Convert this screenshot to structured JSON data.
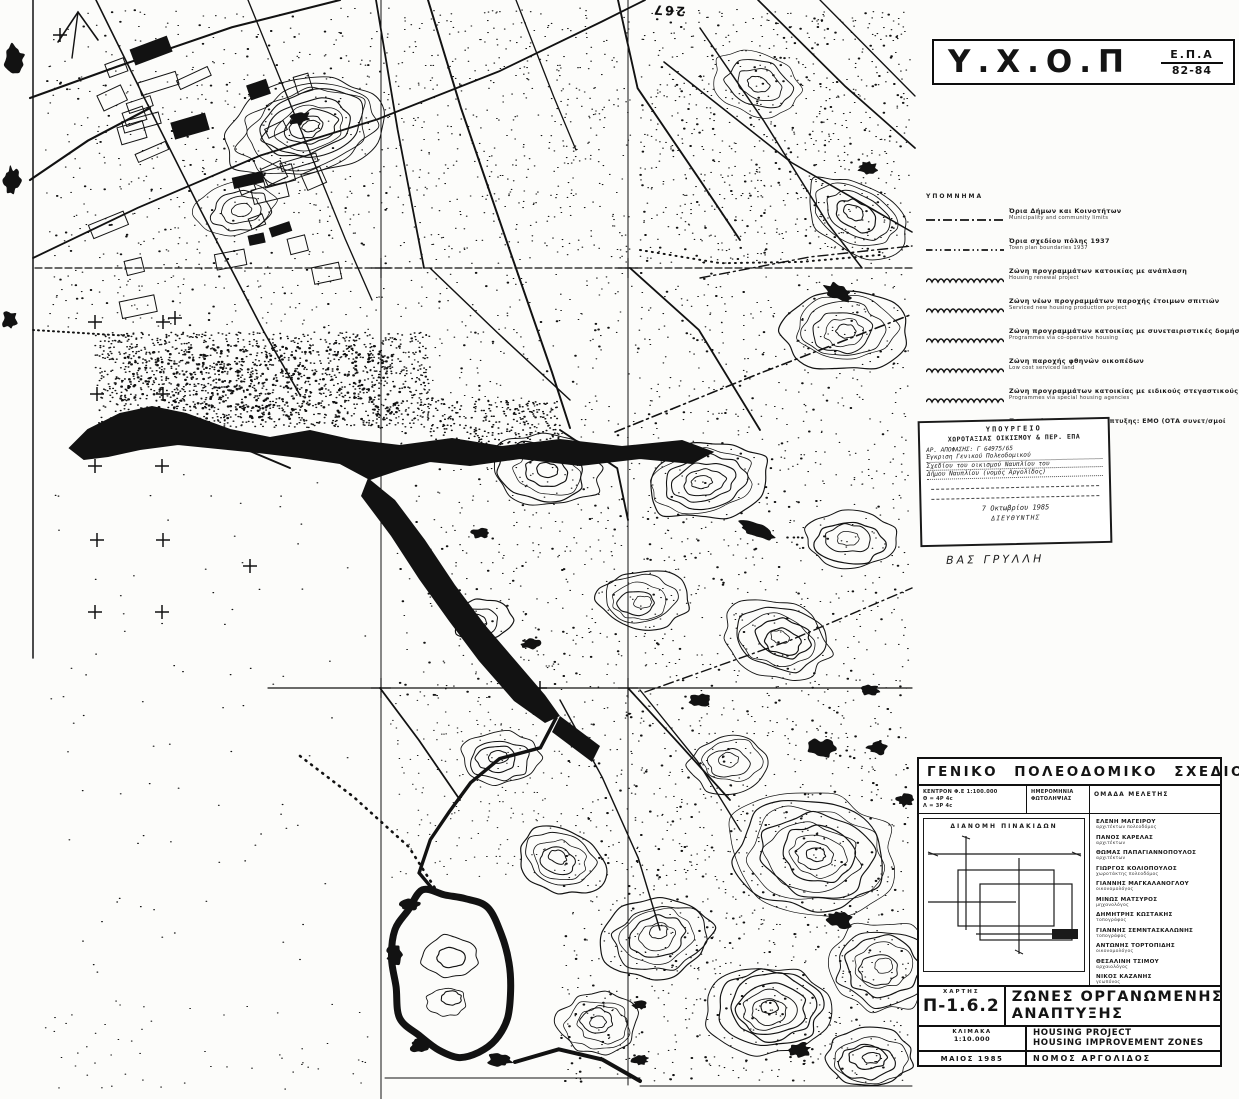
{
  "colors": {
    "ink": "#141414",
    "paper": "#fcfcfa"
  },
  "map": {
    "spot_elevation": "267"
  },
  "title_block": {
    "agency": "Υ.Χ.Ο.Π",
    "program": "Ε.Π.Α",
    "years": "82-84"
  },
  "legend": {
    "heading": "ΥΠΟΜΝΗΜΑ",
    "items": [
      {
        "marker": "dash-dot",
        "label": "Όρια Δήμων και Κοινοτήτων",
        "sublabel": "Municipality and community limits"
      },
      {
        "marker": "dash-dot-dot",
        "label": "Όρια σχεδίου πόλης 1937",
        "sublabel": "Town plan boundaries 1937"
      },
      {
        "marker": "wavy",
        "label": "Ζώνη προγραμμάτων κατοικίας με ανάπλαση",
        "sublabel": "Housing renewal project"
      },
      {
        "marker": "wavy",
        "label": "Ζώνη νέων προγραμμάτων παροχής έτοιμων σπιτιών",
        "sublabel": "Serviced new housing production project"
      },
      {
        "marker": "wavy",
        "label": "Ζώνη προγραμμάτων κατοικίας με συνεταιριστικές δομήσεις",
        "sublabel": "Programmes via co-operative housing"
      },
      {
        "marker": "wavy",
        "label": "Ζώνη παροχής φθηνών οικοπέδων",
        "sublabel": "Low cost serviced land"
      },
      {
        "marker": "wavy",
        "label": "Ζώνη προγραμμάτων κατοικίας με ειδικούς στεγαστικούς φορείς",
        "sublabel": "Programmes via special housing agencies"
      }
    ],
    "note": "Προτεινόμενοι φορείς ανάπτυξης: ΕΜΟ (ΟΤΑ συνετ/σμοί ΟΕΚ)"
  },
  "approval_stamp": {
    "ministry_line1": "ΥΠΟΥΡΓΕΙΟ",
    "ministry_line2": "ΧΩΡΟΤΑΞΙΑΣ ΟΙΚΙΣΜΟΥ & ΠΕΡ. ΕΠΑ",
    "ref_line": "ΑΡ. ΑΠΟΦΑΣΗΣ: Γ 64975/65",
    "body_lines": [
      "Έγκριση Γενικού Πολεοδομικού",
      "Σχεδίου του οικισμού Ναυπλίου του",
      "Δήμου Ναυπλίου (νομός Αργολίδος)"
    ],
    "date": "7 Οκτωβρίου 1985",
    "role": "ΔΙΕΥΘΥΝΤΗΣ",
    "signed_name": "ΒΑΣ ΓΡΥΛΛΗ"
  },
  "info_panel": {
    "title": "ΓΕΝΙΚΟ ΠΟΛΕΟΔΟΜΙΚΟ ΣΧΕΔΙΟ",
    "photo_center_line1": "ΚΕΝΤΡΟΝ Φ.Ε 1:100.000",
    "photo_center_line2": "Θ = 4Ρ 4c",
    "photo_center_line3": "Λ = 3Ρ 4c",
    "photo_date_line1": "ΗΜΕΡΟΜΗΝΙΑ",
    "photo_date_line2": "ΦΩΤΟΛΗΨΙΑΣ",
    "team_label": "ΟΜΑΔΑ ΜΕΛΕΤΗΣ",
    "sheet_index_label": "ΔΙΑΝΟΜΗ ΠΙΝΑΚΙΔΩΝ",
    "team": [
      {
        "name": "ΕΛΕΝΗ ΜΑΓΕΙΡΟΥ",
        "role": "αρχιτέκτων πολεοδόμος"
      },
      {
        "name": "ΠΑΝΟΣ ΚΑΡΕΛΑΣ",
        "role": "αρχιτέκτων"
      },
      {
        "name": "ΘΩΜΑΣ ΠΑΠΑΓΙΑΝΝΟΠΟΥΛΟΣ",
        "role": "αρχιτέκτων"
      },
      {
        "name": "ΓΙΩΡΓΟΣ ΚΟΛΙΟΠΟΥΛΟΣ",
        "role": "χωροτάκτης πολεοδόμος"
      },
      {
        "name": "ΓΙΑΝΝΗΣ ΜΑΓΚΑΛΑΝΟΓΛΟΥ",
        "role": "οικονομολόγος"
      },
      {
        "name": "ΜΙΝΩΣ ΜΑΤΣΥΡΟΣ",
        "role": "μηχανολόγος"
      },
      {
        "name": "ΔΗΜΗΤΡΗΣ ΚΩΣΤΑΚΗΣ",
        "role": "τοπογράφος"
      },
      {
        "name": "ΓΙΑΝΝΗΣ ΣΕΜΝΤΑΣΚΑΛΩΝΗΣ",
        "role": "τοπογράφος"
      },
      {
        "name": "ΑΝΤΩΝΗΣ ΤΟΡΤΟΠΙΔΗΣ",
        "role": "οικονομολόγος"
      },
      {
        "name": "ΘΕΣΑΛΙΝΗ ΤΣΙΜΟΥ",
        "role": "αρχαιολόγος"
      },
      {
        "name": "ΝΙΚΟΣ ΚΑΖΑΝΗΣ",
        "role": "γεωπόνος"
      }
    ]
  },
  "title_table": {
    "map_label": "ΧΑΡΤΗΣ",
    "map_no": "Π-1.6.2",
    "title_gr1": "ΖΩΝΕΣ ΟΡΓΑΝΩΜΕΝΗΣ",
    "title_gr2": "ΑΝΑΠΤΥΞΗΣ",
    "scale_label": "ΚΛΙΜΑΚΑ",
    "scale": "1:10.000",
    "title_en1": "HOUSING PROJECT",
    "title_en2": "HOUSING IMPROVEMENT ZONES",
    "date": "ΜΑΙΟΣ 1985",
    "region": "ΝΟΜΟΣ ΑΡΓΟΛΙΔΟΣ"
  }
}
